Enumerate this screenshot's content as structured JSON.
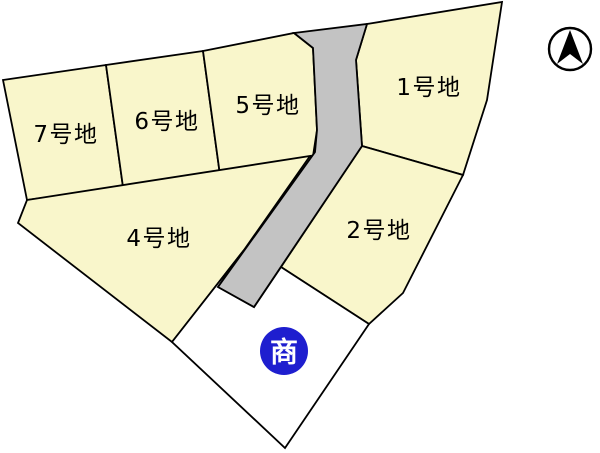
{
  "plan": {
    "background": "#ffffff",
    "outline_color": "#000000",
    "stroke_width": 1.8,
    "lot_fill": "#F9F6CB",
    "road_fill": "#C3C3C3",
    "label_color": "#000000",
    "label_font_size": 23,
    "lots": [
      {
        "name": "lot-7",
        "label": "7号地",
        "points": [
          [
            3,
            80
          ],
          [
            106,
            65
          ],
          [
            123,
            187
          ],
          [
            27,
            200
          ]
        ],
        "label_pos": [
          66,
          135
        ]
      },
      {
        "name": "lot-6",
        "label": "6号地",
        "points": [
          [
            106,
            65
          ],
          [
            203,
            51
          ],
          [
            220,
            175
          ],
          [
            123,
            187
          ]
        ],
        "label_pos": [
          167,
          122
        ]
      },
      {
        "name": "lot-5",
        "label": "5号地",
        "points": [
          [
            203,
            51
          ],
          [
            294,
            33
          ],
          [
            313,
            48
          ],
          [
            317,
            130
          ],
          [
            313,
            156
          ],
          [
            220,
            175
          ]
        ],
        "label_pos": [
          268,
          106
        ]
      },
      {
        "name": "lot-1",
        "label": "1号地",
        "points": [
          [
            367,
            24
          ],
          [
            502,
            2
          ],
          [
            487,
            100
          ],
          [
            463,
            175
          ],
          [
            362,
            146
          ],
          [
            356,
            60
          ]
        ],
        "label_pos": [
          429,
          88
        ]
      },
      {
        "name": "lot-2",
        "label": "2号地",
        "points": [
          [
            362,
            146
          ],
          [
            463,
            175
          ],
          [
            403,
            293
          ],
          [
            369,
            324
          ],
          [
            281,
            267
          ]
        ],
        "label_pos": [
          379,
          231
        ]
      },
      {
        "name": "lot-4",
        "label": "4号地",
        "points": [
          [
            27,
            200
          ],
          [
            310,
            156
          ],
          [
            244,
            250
          ],
          [
            172,
            342
          ],
          [
            18,
            223
          ]
        ],
        "label_pos": [
          159,
          239
        ]
      }
    ],
    "road": {
      "name": "road",
      "points": [
        [
          294,
          33
        ],
        [
          367,
          24
        ],
        [
          356,
          60
        ],
        [
          362,
          146
        ],
        [
          254,
          307
        ],
        [
          218,
          287
        ],
        [
          315,
          152
        ],
        [
          317,
          130
        ],
        [
          313,
          48
        ]
      ]
    },
    "open_area": {
      "name": "open-area",
      "fill": "#ffffff",
      "points": [
        [
          244,
          250
        ],
        [
          218,
          287
        ],
        [
          254,
          307
        ],
        [
          281,
          267
        ],
        [
          369,
          324
        ],
        [
          285,
          448
        ],
        [
          172,
          342
        ]
      ]
    },
    "badge": {
      "label": "商",
      "cx": 284,
      "cy": 351,
      "r": 24,
      "fill": "#1E1ECF",
      "text_color": "#ffffff",
      "font_size": 28
    },
    "compass": {
      "cx": 570,
      "cy": 49,
      "r": 21,
      "ring_color": "#000000",
      "arrow_color": "#000000"
    }
  }
}
